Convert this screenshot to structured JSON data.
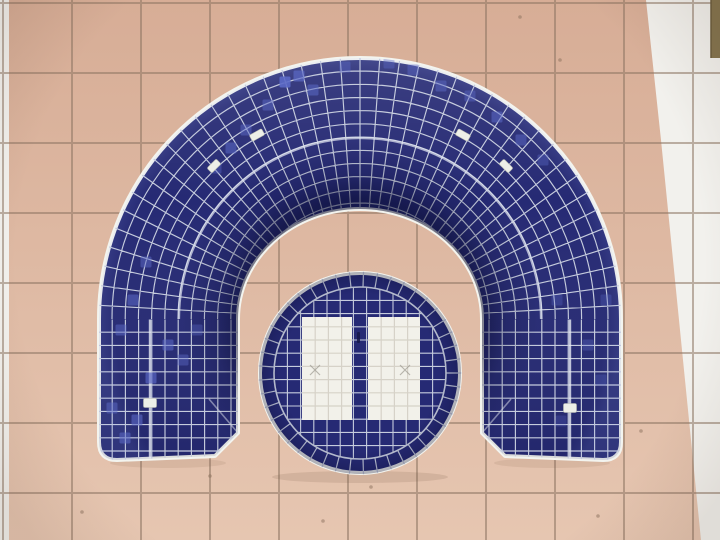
{
  "meta": {
    "subject": "Overhead photograph of a dark blue mosaic-tiled horseshoe bench arching over a round blue mosaic table with two white tiled panels, standing on a salmon-pink square-tiled floor with white edge tiles",
    "type": "photograph"
  },
  "palette": {
    "floor_top": "#d7ad96",
    "floor_bottom": "#e6c6b1",
    "floor_grout": "rgba(141,117,99,0.55)",
    "white_tile": "#f2f1ed",
    "navy": "#262a74",
    "navy_highlight": "#5b69c6",
    "inner_rim_light": "#3e4899",
    "mosaic_grout": "#c6ccdd",
    "rim_white": "#f3f4ef",
    "seam": "#e6eaf3",
    "tab_fill": "#edefe8",
    "tab_stroke": "#b9bcb1",
    "panel_white": "#f2f1ea",
    "panel_grout": "#d6d2c8",
    "mark": "rgba(150,148,138,0.65)",
    "slot": "#161849",
    "corner_bar": "#84744e",
    "speckle": "#8a6f5b",
    "shadow": "rgba(110,80,60,0.15)"
  },
  "scene": {
    "floor": {
      "grout_x": [
        3,
        72,
        141,
        210,
        279,
        348,
        417,
        486,
        555,
        624,
        693
      ],
      "grout_y": [
        3,
        73,
        143,
        213,
        283,
        353,
        423,
        493
      ],
      "left_strip": {
        "x": 0,
        "y": 0,
        "w": 9,
        "h": 540
      },
      "right_wedge_points": "646,0 720,0 720,540 701,540 661,140",
      "corner_bar": {
        "x": 711,
        "y": 0,
        "w": 9,
        "h": 58
      },
      "speckles": [
        [
          213,
          109
        ],
        [
          447,
          372
        ],
        [
          520,
          17
        ],
        [
          641,
          431
        ],
        [
          598,
          516
        ],
        [
          82,
          512
        ],
        [
          323,
          521
        ],
        [
          210,
          476
        ],
        [
          371,
          487
        ],
        [
          560,
          60
        ]
      ]
    },
    "arch": {
      "cx": 360,
      "cy": 319,
      "outer_r": 261,
      "inner_rx": 122,
      "inner_ry": 110,
      "leg_outer_left": 99,
      "leg_inner_left": 238,
      "leg_inner_right": 482,
      "leg_outer_right": 621,
      "leg_bottom": 460,
      "chamfer": 23,
      "corner_r": 18,
      "tile": 13.2,
      "seam_r": 181,
      "seam_x_left": 150,
      "seam_x_right": 570,
      "ray_step": 4.35
    },
    "table": {
      "cx": 360,
      "cy": 373,
      "r": 100,
      "ring_inner_r": 86,
      "tile": 13.2,
      "ray_step": 8,
      "panels": [
        {
          "x": 302,
          "y": 317,
          "w": 50,
          "h": 103
        },
        {
          "x": 368,
          "y": 317,
          "w": 52,
          "h": 103
        }
      ],
      "slot": {
        "x": 357,
        "y": 332,
        "w": 3,
        "h": 11
      },
      "x_marks": [
        [
          315,
          370
        ],
        [
          405,
          370
        ]
      ]
    },
    "tabs": [
      {
        "x": 257,
        "y": 135,
        "rot": -29,
        "w": 14,
        "h": 7
      },
      {
        "x": 463,
        "y": 135,
        "rot": 29,
        "w": 14,
        "h": 7
      },
      {
        "x": 214,
        "y": 166,
        "rot": -45,
        "w": 13,
        "h": 7
      },
      {
        "x": 506,
        "y": 166,
        "rot": 45,
        "w": 13,
        "h": 7
      },
      {
        "x": 150,
        "y": 403,
        "rot": 0,
        "w": 13,
        "h": 9
      },
      {
        "x": 570,
        "y": 408,
        "rot": 0,
        "w": 13,
        "h": 9
      }
    ],
    "highlights": [
      [
        285,
        82,
        0.9
      ],
      [
        299,
        76,
        0.7
      ],
      [
        313,
        90,
        0.55
      ],
      [
        268,
        105,
        0.5
      ],
      [
        246,
        130,
        0.5
      ],
      [
        231,
        148,
        0.55
      ],
      [
        216,
        168,
        0.4
      ],
      [
        345,
        67,
        0.45
      ],
      [
        389,
        63,
        0.4
      ],
      [
        413,
        70,
        0.45
      ],
      [
        441,
        86,
        0.5
      ],
      [
        470,
        96,
        0.45
      ],
      [
        497,
        117,
        0.55
      ],
      [
        521,
        140,
        0.5
      ],
      [
        543,
        160,
        0.4
      ],
      [
        146,
        262,
        0.5
      ],
      [
        133,
        300,
        0.55
      ],
      [
        121,
        330,
        0.5
      ],
      [
        168,
        345,
        0.55
      ],
      [
        183,
        360,
        0.45
      ],
      [
        151,
        378,
        0.65
      ],
      [
        137,
        420,
        0.6
      ],
      [
        125,
        438,
        0.55
      ],
      [
        112,
        408,
        0.5
      ],
      [
        197,
        330,
        0.35
      ],
      [
        557,
        300,
        0.3
      ],
      [
        588,
        345,
        0.35
      ],
      [
        601,
        380,
        0.3
      ],
      [
        561,
        421,
        0.25
      ],
      [
        606,
        300,
        0.3
      ]
    ]
  }
}
